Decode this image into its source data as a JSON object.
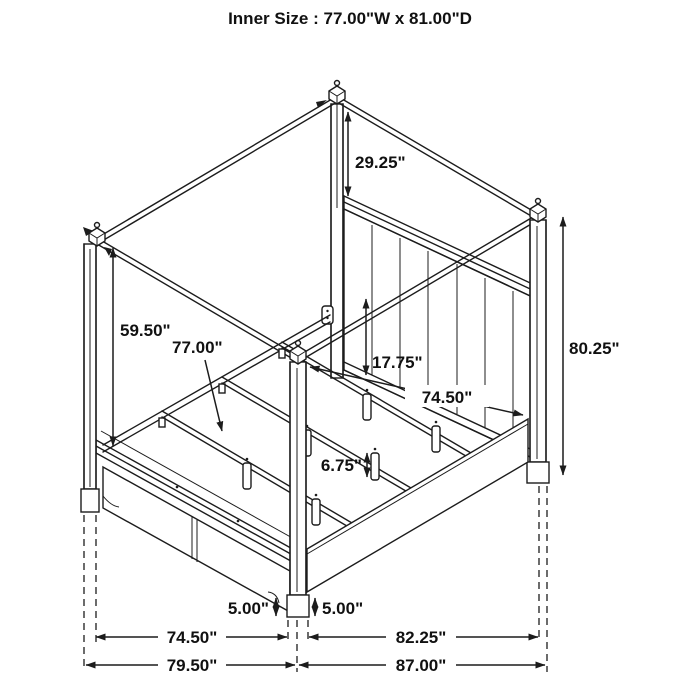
{
  "title": "Inner Size : 77.00\"W x 81.00\"D",
  "diagram": {
    "subject": "canopy-bed-dimension-drawing",
    "labels": {
      "canopy_height": "29.25\"",
      "post_clear_height": "59.50\"",
      "slat_width": "77.00\"",
      "rail_height": "17.75\"",
      "inner_depth": "74.50\"",
      "slat_leg_height": "6.75\"",
      "overall_height": "80.25\"",
      "foot_clearance_left": "5.00\"",
      "foot_clearance_right": "5.00\"",
      "footboard_inner_width": "74.50\"",
      "footboard_outer_width": "79.50\"",
      "side_inner_depth": "82.25\"",
      "side_outer_depth": "87.00\""
    }
  }
}
